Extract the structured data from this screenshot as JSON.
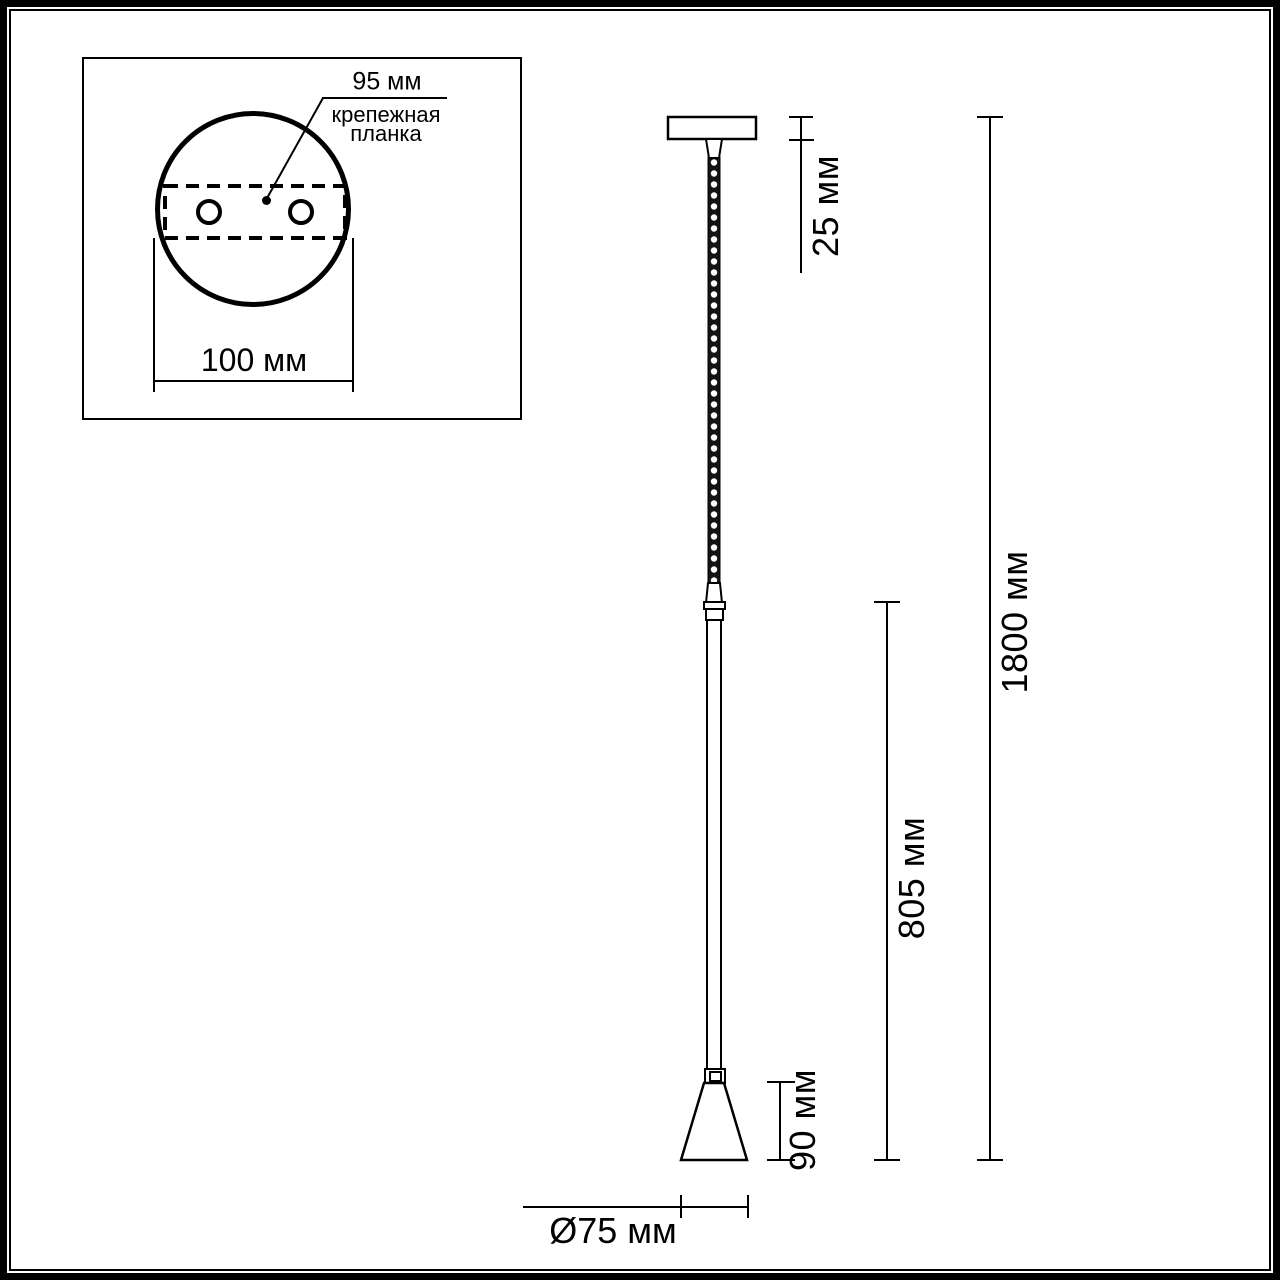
{
  "diagram": {
    "title_semantic": "pendant-lamp-dimension-drawing",
    "colors": {
      "line": "#000000",
      "background": "#ffffff"
    },
    "inset": {
      "hole_spacing_label": "95 мм",
      "plate_name_lines": [
        "крепежная",
        "планка"
      ],
      "plate_width_label": "100 мм"
    },
    "dimensions": {
      "canopy_height": "25 мм",
      "total_height": "1800 мм",
      "rod_length": "805 мм",
      "shade_height": "90 мм",
      "shade_diameter": "Ø75 мм"
    }
  }
}
